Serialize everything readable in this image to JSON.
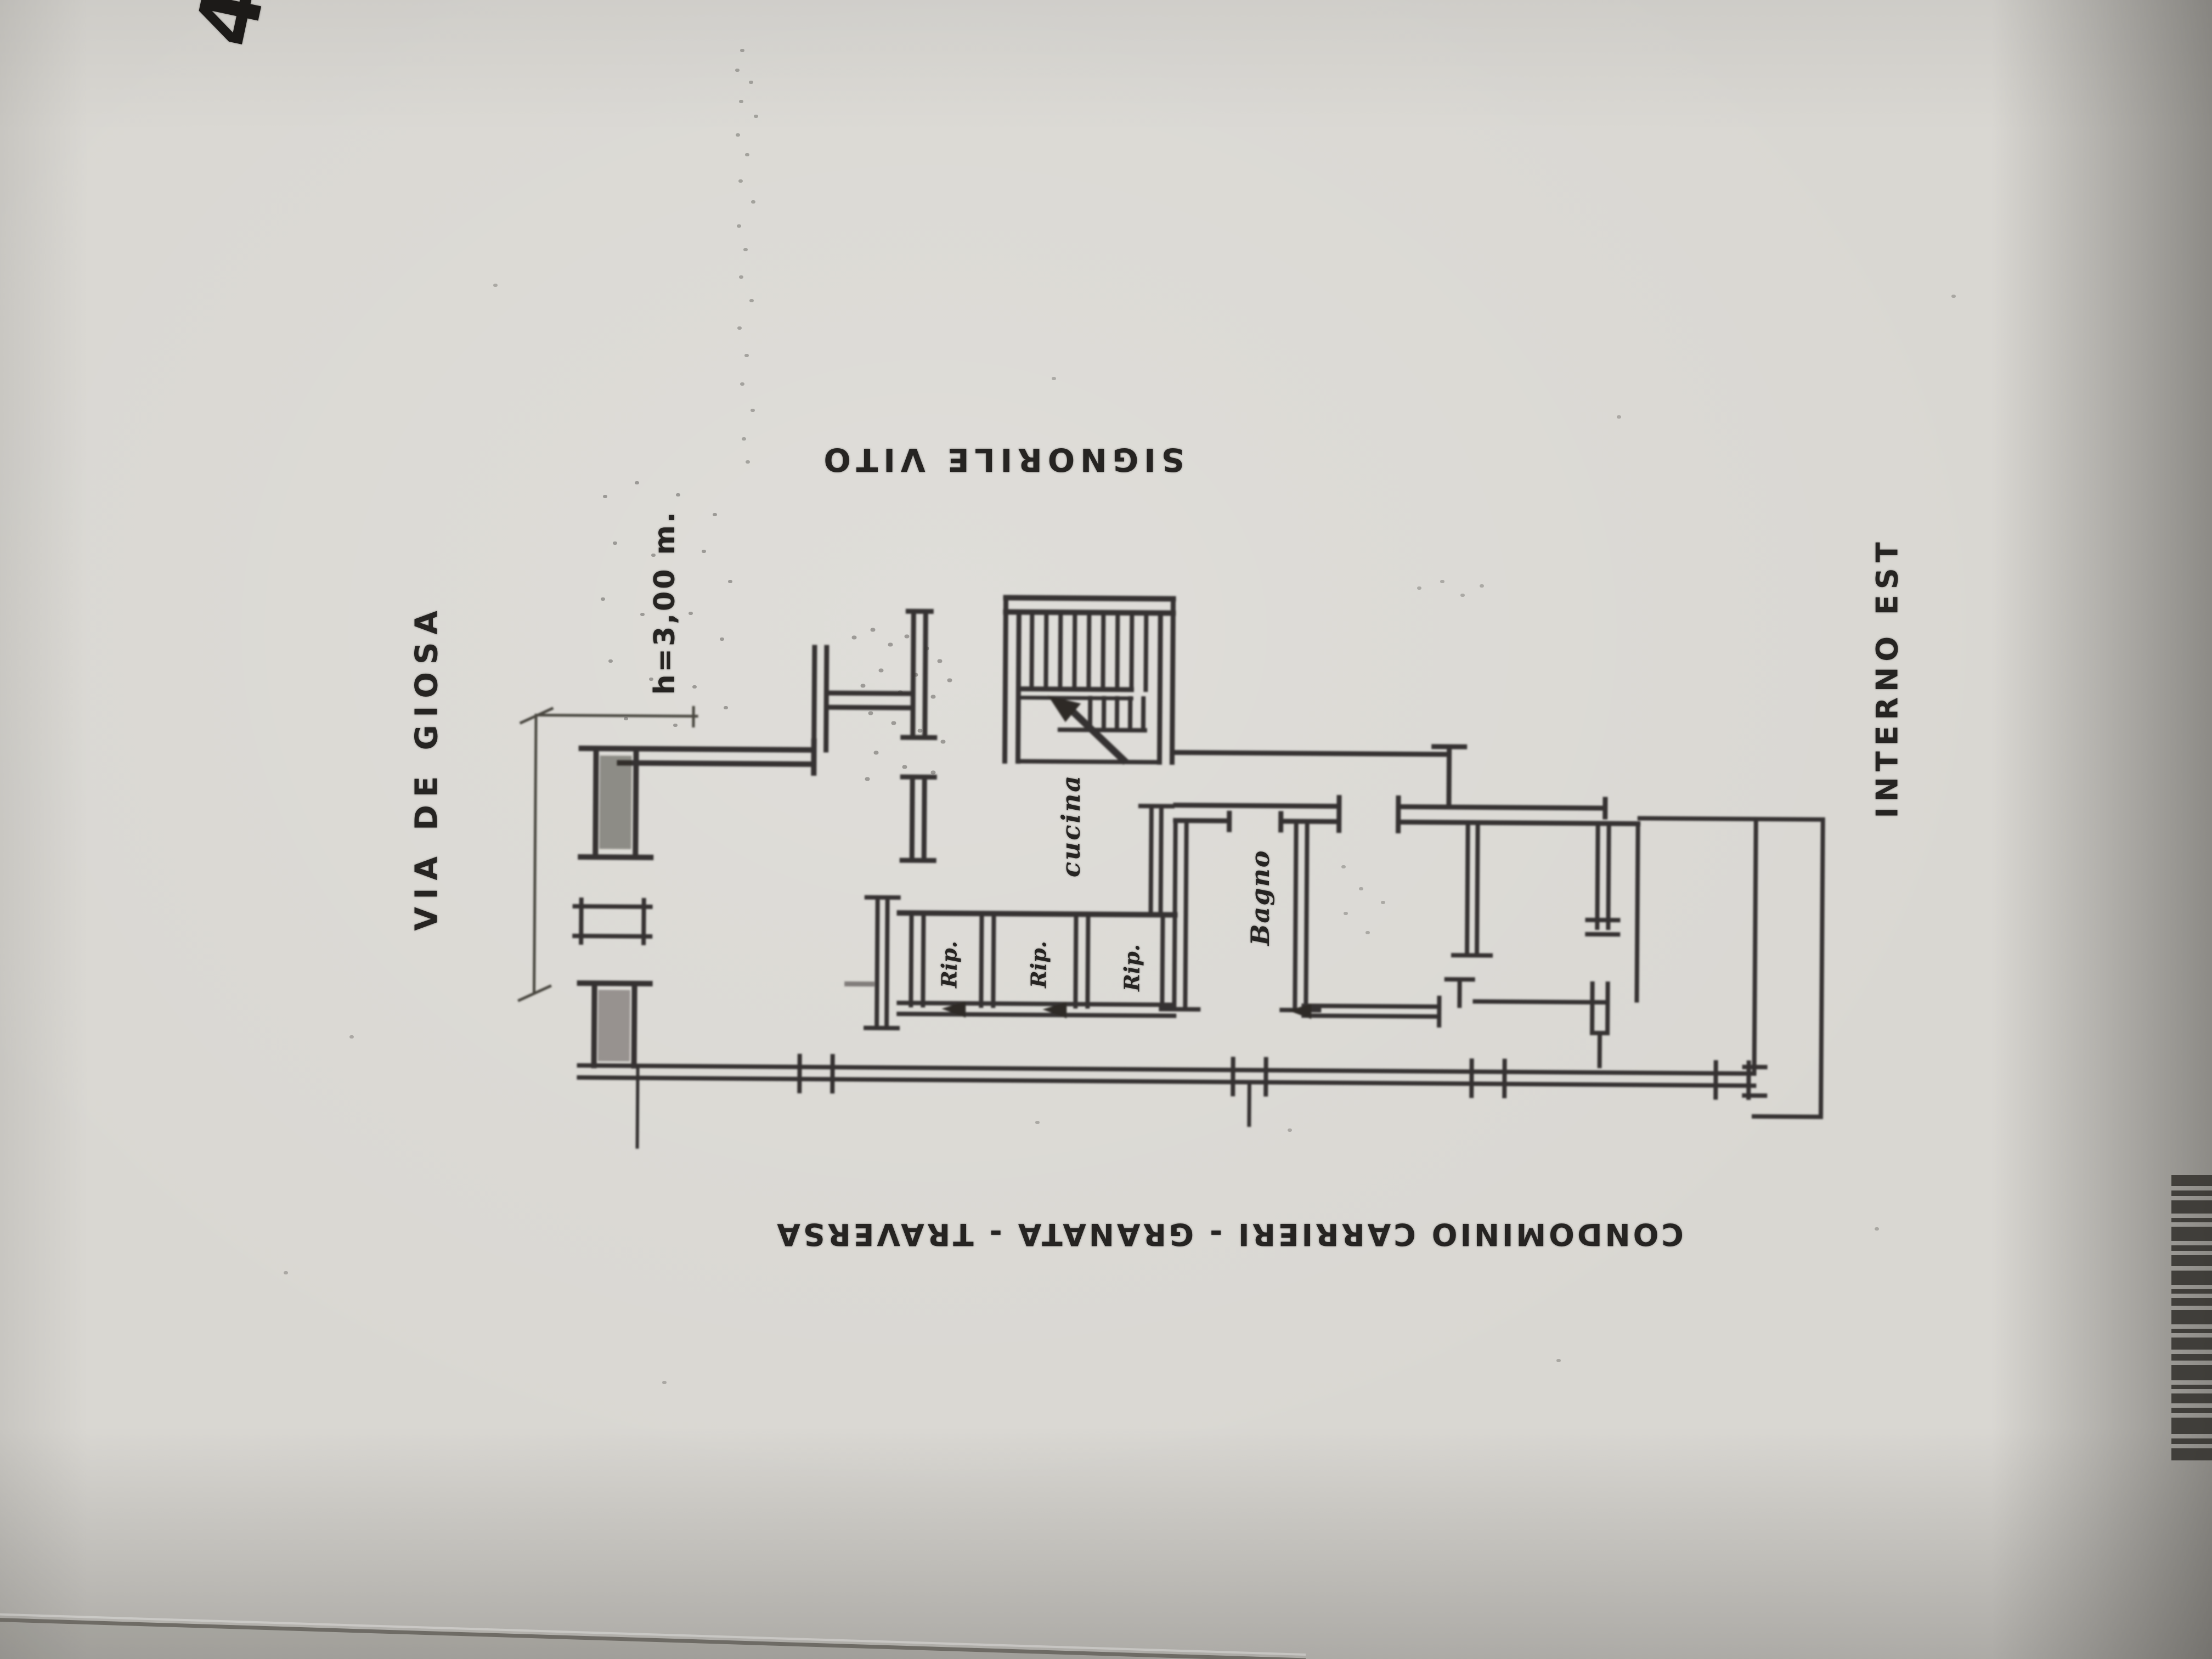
{
  "page": {
    "corner_mark": "4",
    "labels": {
      "street": "VIA DE GIOSA",
      "height": "h=3,00 m.",
      "owner": "SIGNORILE VITO",
      "interior_side": "INTERNO EST",
      "condominium": "CONDOMINIO CARRIERI - GRANATA - TRAVERSA"
    },
    "rooms": {
      "kitchen": "cucina",
      "bathroom": "Bagno",
      "storage_1": "Rip.",
      "storage_2": "Rip.",
      "storage_3": "Rip."
    },
    "colors": {
      "paper": "#d9d7d2",
      "ink": "#2e2b28",
      "shadow": "#57544e"
    }
  }
}
